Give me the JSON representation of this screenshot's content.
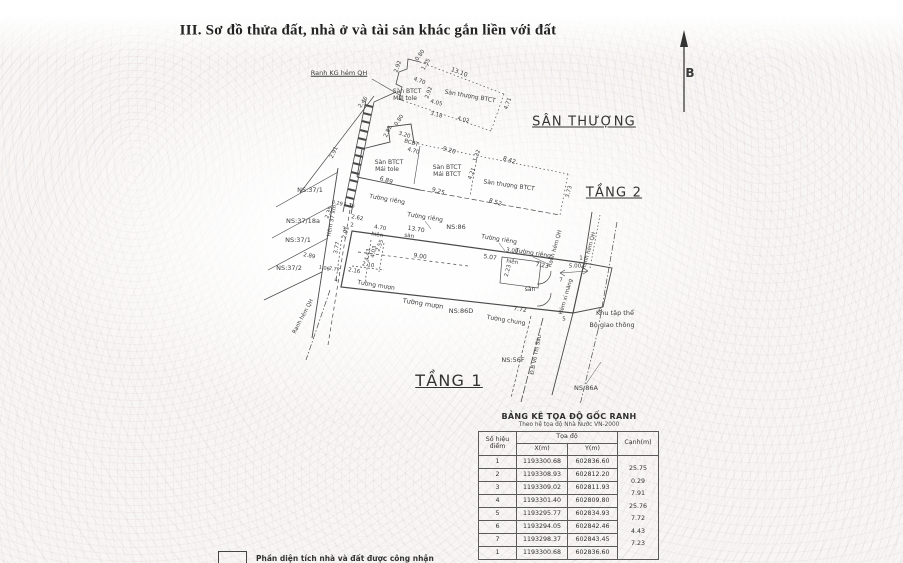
{
  "page": {
    "title": "III. Sơ đồ thửa đất, nhà ở và tài sản khác gắn liền với đất"
  },
  "compass": {
    "label": "B"
  },
  "drawing": {
    "labels": [
      {
        "t": "SÂN THƯỢNG",
        "x": 584,
        "y": 122,
        "fs": 13,
        "cls": "und head",
        "n": "heading-san-thuong"
      },
      {
        "t": "TẦNG 2",
        "x": 614,
        "y": 193,
        "fs": 13,
        "cls": "und head",
        "n": "heading-tang-2"
      },
      {
        "t": "TẦNG 1",
        "x": 449,
        "y": 381,
        "fs": 16,
        "cls": "und head",
        "n": "heading-tang-1"
      },
      {
        "t": "B",
        "x": 690,
        "y": 73,
        "fs": 12,
        "cls": "bold",
        "n": "north-label"
      },
      {
        "t": "Ranh KG hẻm QH",
        "x": 339,
        "y": 73,
        "fs": 6.5,
        "cls": "und",
        "n": "boundary-label"
      },
      {
        "t": "0.80",
        "x": 421,
        "y": 56,
        "r": -55,
        "fs": 5.5
      },
      {
        "t": "1.35",
        "x": 427,
        "y": 65,
        "r": -60,
        "fs": 5.5
      },
      {
        "t": "2.92",
        "x": 399,
        "y": 67,
        "r": -70,
        "fs": 5.5
      },
      {
        "t": "13.10",
        "x": 459,
        "y": 73,
        "r": 21,
        "fs": 6
      },
      {
        "t": "4.70",
        "x": 419,
        "y": 82,
        "r": 21,
        "fs": 5.5
      },
      {
        "t": "2.92",
        "x": 430,
        "y": 93,
        "r": -70,
        "fs": 5.5
      },
      {
        "t": "Sàn BTCT",
        "x": 407,
        "y": 92,
        "fs": 6,
        "n": "surface-label"
      },
      {
        "t": "Mái tole",
        "x": 405,
        "y": 99,
        "fs": 6,
        "n": "surface-label"
      },
      {
        "t": "Sàn thượng BTCT",
        "x": 470,
        "y": 97,
        "r": 10,
        "fs": 6,
        "n": "surface-label"
      },
      {
        "t": "4.05",
        "x": 436,
        "y": 104,
        "r": 15,
        "fs": 5.5
      },
      {
        "t": "3.18",
        "x": 436,
        "y": 116,
        "r": 15,
        "fs": 5.5
      },
      {
        "t": "4.02",
        "x": 463,
        "y": 121,
        "r": 15,
        "fs": 5.5
      },
      {
        "t": "4.71",
        "x": 509,
        "y": 104,
        "r": -70,
        "fs": 5.5
      },
      {
        "t": "2.46",
        "x": 364,
        "y": 103,
        "r": -55,
        "fs": 5.5
      },
      {
        "t": "0.80",
        "x": 400,
        "y": 121,
        "r": -55,
        "fs": 5.5
      },
      {
        "t": "2.82",
        "x": 389,
        "y": 132,
        "r": -65,
        "fs": 5.5
      },
      {
        "t": "3.20",
        "x": 404,
        "y": 136,
        "r": 17,
        "fs": 5.5
      },
      {
        "t": "BCBT",
        "x": 411,
        "y": 144,
        "r": 17,
        "fs": 5.5,
        "n": "surface-label"
      },
      {
        "t": "4.70",
        "x": 413,
        "y": 152,
        "r": 17,
        "fs": 5.5
      },
      {
        "t": "2.91",
        "x": 335,
        "y": 153,
        "r": -65,
        "fs": 5.5
      },
      {
        "t": "9.20",
        "x": 449,
        "y": 151,
        "r": 17,
        "fs": 6
      },
      {
        "t": "1.32",
        "x": 478,
        "y": 156,
        "r": -70,
        "fs": 5.5
      },
      {
        "t": "8.42",
        "x": 509,
        "y": 161,
        "r": 17,
        "fs": 6
      },
      {
        "t": "Sàn BTCT",
        "x": 389,
        "y": 163,
        "fs": 6,
        "n": "surface-label"
      },
      {
        "t": "Mái tole",
        "x": 387,
        "y": 170,
        "fs": 6,
        "n": "surface-label"
      },
      {
        "t": "Sàn BTCT",
        "x": 447,
        "y": 168,
        "fs": 6,
        "n": "surface-label"
      },
      {
        "t": "Mái BTCT",
        "x": 447,
        "y": 175,
        "fs": 6,
        "n": "surface-label"
      },
      {
        "t": "4.21",
        "x": 473,
        "y": 174,
        "r": -70,
        "fs": 5.5
      },
      {
        "t": "Sàn thượng BTCT",
        "x": 509,
        "y": 186,
        "r": 8,
        "fs": 6,
        "n": "surface-label"
      },
      {
        "t": "6.89",
        "x": 386,
        "y": 181,
        "r": 17,
        "fs": 6
      },
      {
        "t": "9.25",
        "x": 438,
        "y": 192,
        "r": 17,
        "fs": 6
      },
      {
        "t": "8.52",
        "x": 495,
        "y": 203,
        "r": 17,
        "fs": 6
      },
      {
        "t": "3.73",
        "x": 570,
        "y": 192,
        "r": -75,
        "fs": 5.5
      },
      {
        "t": "NS:37/1",
        "x": 310,
        "y": 190,
        "fs": 6.5,
        "n": "ns-parcel-label"
      },
      {
        "t": "NS:37/18a",
        "x": 303,
        "y": 221,
        "fs": 6.5,
        "n": "ns-parcel-label"
      },
      {
        "t": "NS:37/1",
        "x": 298,
        "y": 240,
        "fs": 6.5,
        "n": "ns-parcel-label"
      },
      {
        "t": "NS:37/2",
        "x": 289,
        "y": 268,
        "fs": 6.5,
        "n": "ns-parcel-label"
      },
      {
        "t": "Hẻm 37 xm",
        "x": 333,
        "y": 221,
        "r": -79,
        "fs": 5.5,
        "n": "alley-label"
      },
      {
        "t": "Ranh hẻm QH",
        "x": 304,
        "y": 317,
        "r": -62,
        "fs": 5.5,
        "n": "boundary-label"
      },
      {
        "t": "0.29",
        "x": 337,
        "y": 204,
        "r": 12,
        "fs": 5
      },
      {
        "t": "1.36",
        "x": 349,
        "y": 206,
        "r": 12,
        "fs": 5
      },
      {
        "t": "2.35",
        "x": 330,
        "y": 213,
        "r": -70,
        "fs": 5.5
      },
      {
        "t": "Tường riêng",
        "x": 387,
        "y": 200,
        "r": 10,
        "fs": 6,
        "n": "wall-label"
      },
      {
        "t": "2.62",
        "x": 357,
        "y": 219,
        "r": 12,
        "fs": 5.5
      },
      {
        "t": "Tường riêng",
        "x": 425,
        "y": 218,
        "r": 9,
        "fs": 6,
        "n": "wall-label"
      },
      {
        "t": "13.70",
        "x": 416,
        "y": 230,
        "r": 9,
        "fs": 6
      },
      {
        "t": "4.70",
        "x": 380,
        "y": 229,
        "r": 9,
        "fs": 5.5
      },
      {
        "t": "hiên",
        "x": 377,
        "y": 236,
        "r": 9,
        "fs": 5.5,
        "n": "porch-label"
      },
      {
        "t": "sàn",
        "x": 409,
        "y": 237,
        "r": 9,
        "fs": 5.5,
        "n": "surface-label"
      },
      {
        "t": "NS:86",
        "x": 456,
        "y": 227,
        "fs": 6.5,
        "n": "ns-parcel-label"
      },
      {
        "t": "2.91",
        "x": 347,
        "y": 233,
        "r": -75,
        "fs": 5.5
      },
      {
        "t": "3.77",
        "x": 338,
        "y": 248,
        "r": -78,
        "fs": 5.5
      },
      {
        "t": "4.43",
        "x": 369,
        "y": 255,
        "r": -78,
        "fs": 5.5
      },
      {
        "t": "2.55",
        "x": 381,
        "y": 246,
        "r": -70,
        "fs": 5.5
      },
      {
        "t": "4.03",
        "x": 375,
        "y": 252,
        "r": -78,
        "fs": 5.5
      },
      {
        "t": "9.00",
        "x": 420,
        "y": 257,
        "r": 9,
        "fs": 6
      },
      {
        "t": "5.07",
        "x": 490,
        "y": 258,
        "r": 9,
        "fs": 6
      },
      {
        "t": "Tường riêng",
        "x": 499,
        "y": 240,
        "r": 9,
        "fs": 6,
        "n": "wall-label"
      },
      {
        "t": "3.00",
        "x": 512,
        "y": 252,
        "r": 9,
        "fs": 5.5
      },
      {
        "t": "hiên",
        "x": 512,
        "y": 263,
        "r": 9,
        "fs": 5.5,
        "n": "porch-label"
      },
      {
        "t": "Tường riêng",
        "x": 533,
        "y": 254,
        "r": 9,
        "fs": 6,
        "n": "wall-label"
      },
      {
        "t": "7.23",
        "x": 542,
        "y": 266,
        "r": 9,
        "fs": 6
      },
      {
        "t": "2.23",
        "x": 509,
        "y": 271,
        "r": -75,
        "fs": 5.5
      },
      {
        "t": "sàn",
        "x": 530,
        "y": 290,
        "fs": 6,
        "n": "surface-label"
      },
      {
        "t": "2.89",
        "x": 309,
        "y": 257,
        "r": 12,
        "fs": 5.5
      },
      {
        "t": "1.06",
        "x": 324,
        "y": 269,
        "r": 12,
        "fs": 5
      },
      {
        "t": "2.77",
        "x": 334,
        "y": 270,
        "r": 12,
        "fs": 5
      },
      {
        "t": "2.16",
        "x": 354,
        "y": 272,
        "r": 10,
        "fs": 5.5
      },
      {
        "t": "2.10",
        "x": 368,
        "y": 266,
        "r": 10,
        "fs": 5.5
      },
      {
        "t": "Tường mượn",
        "x": 376,
        "y": 286,
        "r": 9,
        "fs": 6,
        "n": "wall-label"
      },
      {
        "t": "Tường mượn",
        "x": 423,
        "y": 304,
        "r": 9,
        "fs": 6.5,
        "n": "wall-label"
      },
      {
        "t": "NS:86D",
        "x": 461,
        "y": 311,
        "fs": 6.5,
        "n": "ns-parcel-label"
      },
      {
        "t": "Tường chung",
        "x": 506,
        "y": 321,
        "r": 9,
        "fs": 6,
        "n": "wall-label"
      },
      {
        "t": "7.72",
        "x": 520,
        "y": 310,
        "r": 9,
        "fs": 6
      },
      {
        "t": "1",
        "x": 581,
        "y": 259,
        "fs": 5.5,
        "n": "point-number"
      },
      {
        "t": "7",
        "x": 561,
        "y": 281,
        "fs": 5.5,
        "n": "point-number"
      },
      {
        "t": "6",
        "x": 600,
        "y": 312,
        "fs": 5.5,
        "n": "point-number"
      },
      {
        "t": "5",
        "x": 564,
        "y": 320,
        "fs": 5.5,
        "n": "point-number"
      },
      {
        "t": "4",
        "x": 336,
        "y": 281,
        "fs": 5.5,
        "n": "point-number"
      },
      {
        "t": "2",
        "x": 352,
        "y": 226,
        "fs": 5.5,
        "n": "point-number"
      },
      {
        "t": "3",
        "x": 344,
        "y": 230,
        "fs": 5.5,
        "n": "point-number"
      },
      {
        "t": "Ranh hẻm QH",
        "x": 556,
        "y": 249,
        "r": -74,
        "fs": 5.5,
        "n": "boundary-label"
      },
      {
        "t": "Ranh hẻm QH",
        "x": 590,
        "y": 251,
        "r": -74,
        "fs": 5.5,
        "n": "boundary-label"
      },
      {
        "t": "5.00",
        "x": 575,
        "y": 267,
        "fs": 5.5
      },
      {
        "t": "Hẻm  xi măng",
        "x": 567,
        "y": 297,
        "r": -74,
        "fs": 5.5,
        "n": "alley-label"
      },
      {
        "t": "Khu tập thể",
        "x": 615,
        "y": 313,
        "fs": 6.5,
        "n": "area-label"
      },
      {
        "t": "Bộ giao thông",
        "x": 612,
        "y": 325,
        "fs": 6.5,
        "n": "area-label"
      },
      {
        "t": "NS:56F",
        "x": 513,
        "y": 360,
        "fs": 6.5,
        "n": "ns-parcel-label"
      },
      {
        "t": "Đ.B Võ Thị Sáu",
        "x": 537,
        "y": 355,
        "r": -79,
        "fs": 5.5,
        "n": "street-label"
      },
      {
        "t": "NS:86A",
        "x": 586,
        "y": 388,
        "fs": 6.5,
        "n": "ns-parcel-label"
      }
    ]
  },
  "table": {
    "title": "BẢNG KÊ TỌA ĐỘ GỐC RANH",
    "subtitle": "Theo hệ tọa độ Nhà Nước VN-2000",
    "headers": {
      "point": "Số hiệu điểm",
      "coords": "Tọa độ",
      "x": "X(m)",
      "y": "Y(m)",
      "edge": "Cạnh(m)"
    },
    "rows": [
      [
        "1",
        "1193300.68",
        "602836.60"
      ],
      [
        "2",
        "1193308.93",
        "602812.20"
      ],
      [
        "3",
        "1193309.02",
        "602811.93"
      ],
      [
        "4",
        "1193301.40",
        "602809.80"
      ],
      [
        "5",
        "1193295.77",
        "602834.93"
      ],
      [
        "6",
        "1193294.05",
        "602842.46"
      ],
      [
        "7",
        "1193298.37",
        "602843.45"
      ],
      [
        "1",
        "1193300.68",
        "602836.60"
      ]
    ],
    "edges": [
      "25.75",
      "0.29",
      "7.91",
      "25.76",
      "7.72",
      "4.43",
      "7.23"
    ]
  },
  "legend": {
    "text": "Phần diện tích nhà và đất được công nhận"
  }
}
